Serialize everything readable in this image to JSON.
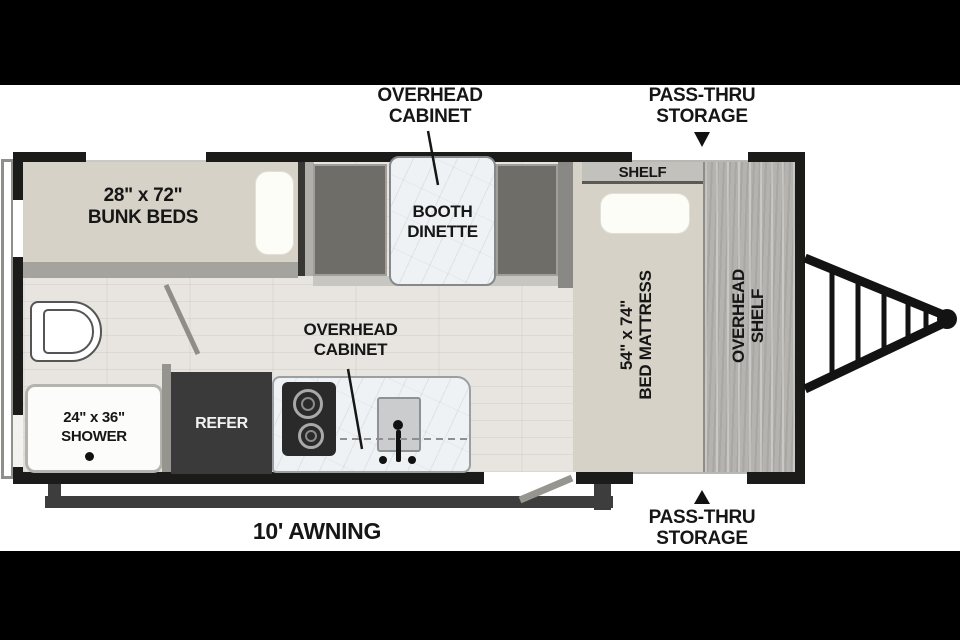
{
  "plan_title": "travel-trailer-floorplan",
  "labels": {
    "overhead_cabinet_top": {
      "l1": "OVERHEAD",
      "l2": "CABINET"
    },
    "pass_thru_top": {
      "l1": "PASS-THRU",
      "l2": "STORAGE"
    },
    "bunk_beds": {
      "l1": "28\" x 72\"",
      "l2": "BUNK BEDS"
    },
    "booth_dinette": {
      "l1": "BOOTH",
      "l2": "DINETTE"
    },
    "shelf": "SHELF",
    "bed_mattress": {
      "l1": "54\" x 74\"",
      "l2": "BED MATTRESS"
    },
    "overhead_shelf": {
      "l1": "OVERHEAD",
      "l2": "SHELF"
    },
    "shower": {
      "l1": "24\" x 36\"",
      "l2": "SHOWER"
    },
    "refer": "REFER",
    "overhead_cabinet_kitchen": {
      "l1": "OVERHEAD",
      "l2": "CABINET"
    },
    "awning": "10' AWNING",
    "pass_thru_bottom": {
      "l1": "PASS-THRU",
      "l2": "STORAGE"
    }
  },
  "colors": {
    "wall": "#1b1b19",
    "bunk_bed_beige": "#d7d2c7",
    "floor": "#e8e5e0",
    "bench_gray": "#6f6d68",
    "table_marble": "#eff2f4",
    "wood_panel": "#b4b3b0",
    "refer_box": "#3a3a3a",
    "awning_bar": "#3d3d3d",
    "label_text": "#161616"
  }
}
